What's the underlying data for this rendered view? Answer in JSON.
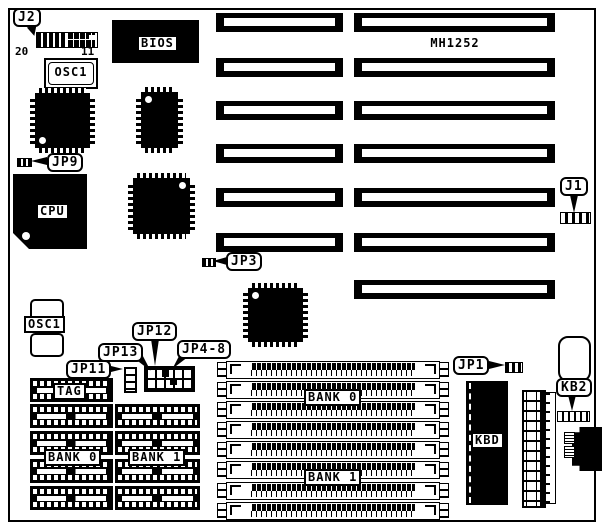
{
  "title": "MH1252",
  "callouts": {
    "j2": "J2",
    "jp9": "JP9",
    "j1": "J1",
    "jp3": "JP3",
    "jp12": "JP12",
    "jp13": "JP13",
    "jp4_8": "JP4-8",
    "jp11": "JP11",
    "jp1": "JP1",
    "kb2": "KB2"
  },
  "labels": {
    "bios": "BIOS",
    "osc_top": "OSC1",
    "osc_mid": "OSC1",
    "cpu": "CPU",
    "tag": "TAG",
    "dip_bank0": "BANK 0",
    "dip_bank1": "BANK 1",
    "simm_bank0": "BANK 0",
    "simm_bank1": "BANK 1",
    "kbd": "KBD"
  },
  "pins": {
    "j2_left": "20",
    "j2_right": "11"
  },
  "colors": {
    "ink": "#000000",
    "paper": "#ffffff"
  }
}
